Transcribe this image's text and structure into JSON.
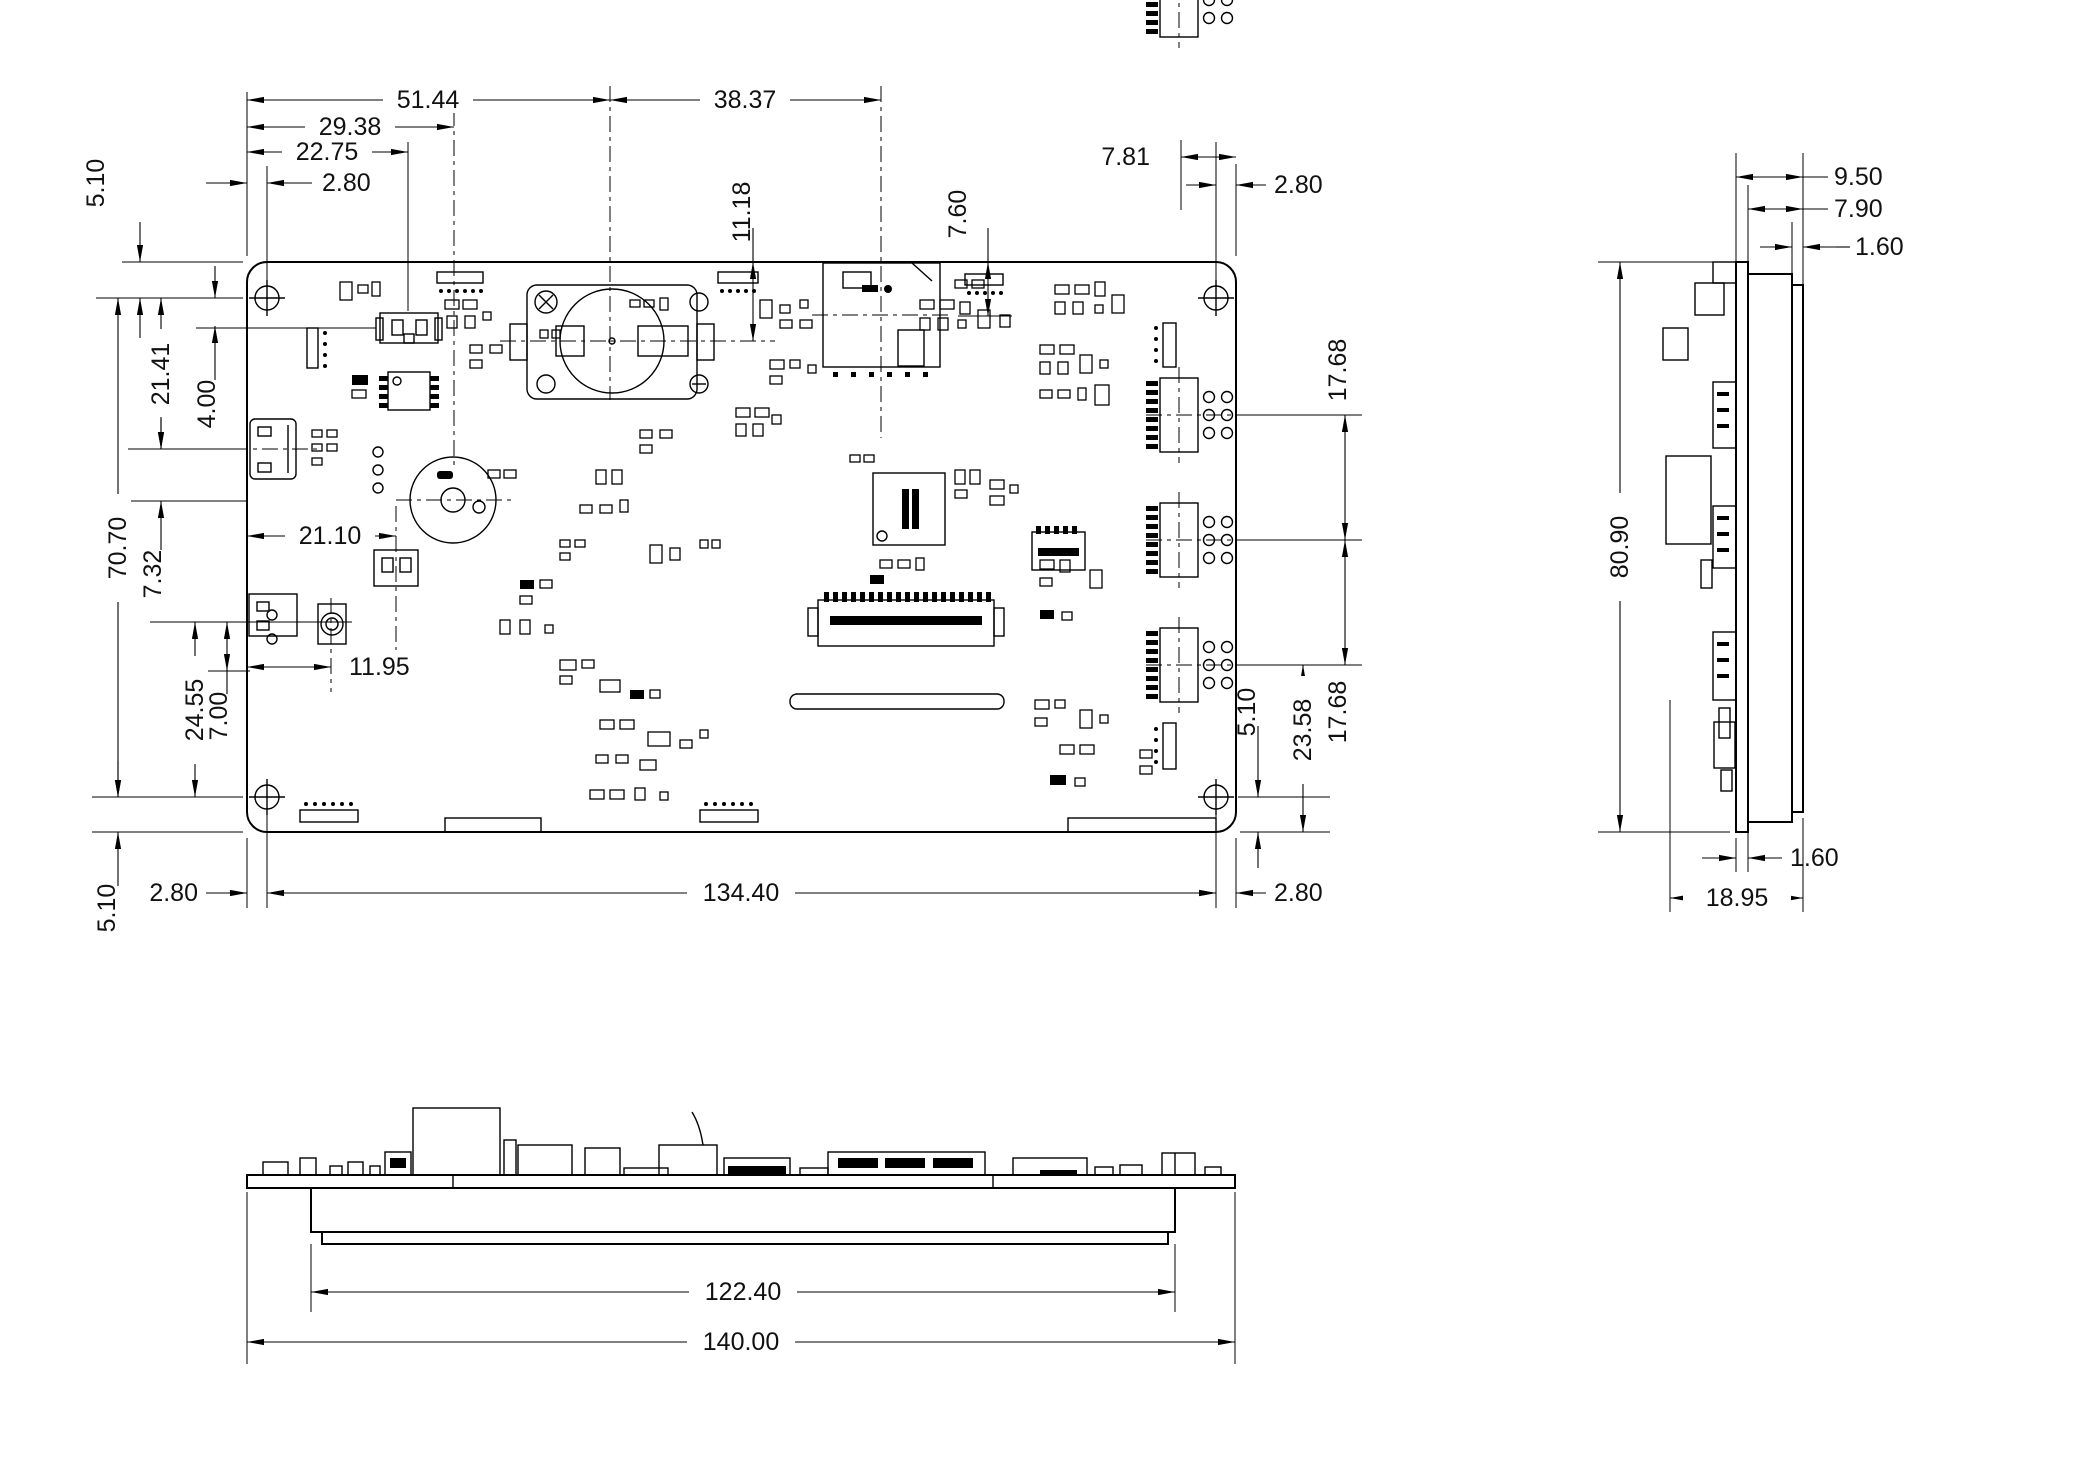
{
  "drawing": {
    "kind": "pcb-mechanical-dimension-drawing",
    "labels": {
      "d51_44": "51.44",
      "d38_37": "38.37",
      "d29_38": "29.38",
      "d22_75": "22.75",
      "d2_80_tl": "2.80",
      "d5_10_tl": "5.10",
      "d11_18": "11.18",
      "d7_60": "7.60",
      "d7_81": "7.81",
      "d2_80_tr": "2.80",
      "d21_41": "21.41",
      "d4_00": "4.00",
      "d70_70": "70.70",
      "d7_32": "7.32",
      "d21_10": "21.10",
      "d11_95": "11.95",
      "d24_55": "24.55",
      "d7_00": "7.00",
      "d17_68_top": "17.68",
      "d17_68_bottom": "17.68",
      "d5_10_right": "5.10",
      "d23_58": "23.58",
      "d5_10_bl": "5.10",
      "d2_80_bl": "2.80",
      "d134_40": "134.40",
      "d2_80_br": "2.80",
      "d9_50": "9.50",
      "d7_90": "7.90",
      "d1_60_top": "1.60",
      "d80_90": "80.90",
      "d1_60_bottom": "1.60",
      "d18_95": "18.95",
      "d122_40": "122.40",
      "d140_00": "140.00"
    }
  }
}
